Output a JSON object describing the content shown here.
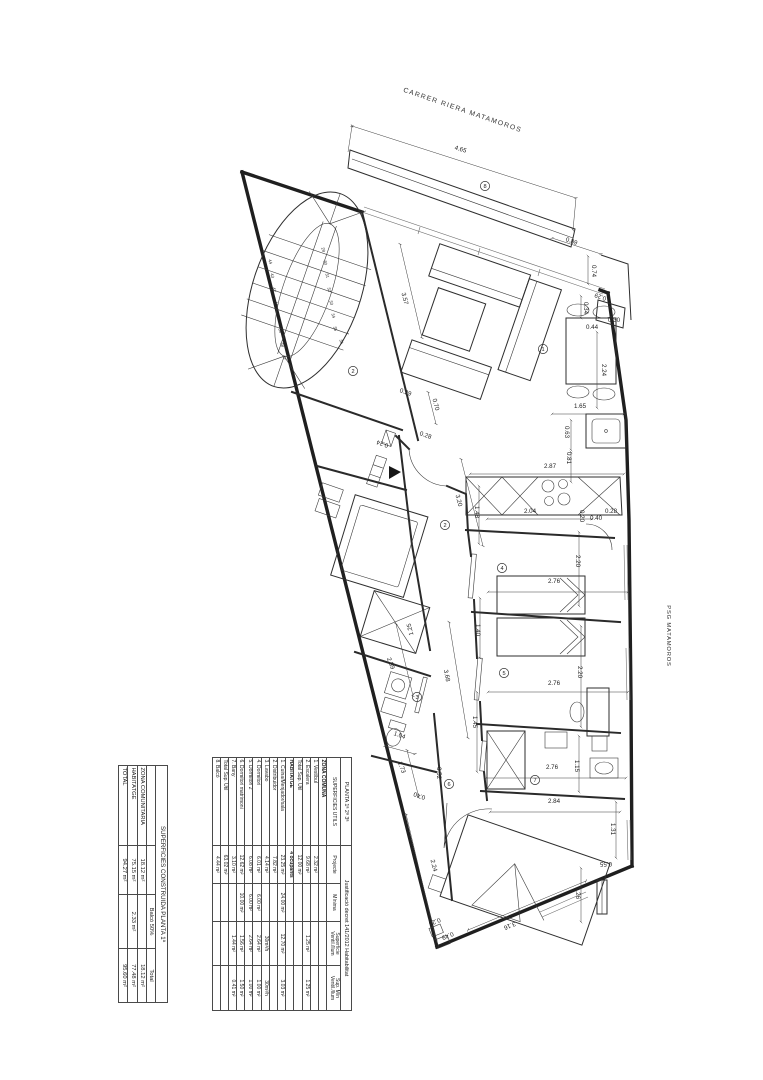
{
  "colors": {
    "ink": "#1f1f1f",
    "paper": "#ffffff"
  },
  "plan": {
    "street_labels": [
      {
        "text": "CARRER RIERA MATAMOROS",
        "x": 462,
        "y": 112,
        "r": 19,
        "s": 6.8,
        "cls": "street"
      },
      {
        "text": "PSG MATAMOROS",
        "x": 667,
        "y": 636,
        "r": 90,
        "s": 5.8,
        "cls": "psg"
      }
    ],
    "dimensions": [
      {
        "t": "4.65",
        "x": 460,
        "y": 151,
        "r": 17
      },
      {
        "t": "0.89",
        "x": 571,
        "y": 243,
        "r": 19
      },
      {
        "t": "0.74",
        "x": 592,
        "y": 271,
        "r": 90
      },
      {
        "t": "0.29",
        "x": 601,
        "y": 295,
        "r": 199
      },
      {
        "t": "0.34",
        "x": 584,
        "y": 308,
        "r": 90
      },
      {
        "t": "0.44",
        "x": 592,
        "y": 329,
        "r": 0
      },
      {
        "t": "0.30",
        "x": 614,
        "y": 322,
        "r": 0
      },
      {
        "t": "2.24",
        "x": 602,
        "y": 370,
        "r": 90
      },
      {
        "t": "1.65",
        "x": 580,
        "y": 408,
        "r": 0
      },
      {
        "t": "0.63",
        "x": 565,
        "y": 432,
        "r": 90
      },
      {
        "t": "0.81",
        "x": 567,
        "y": 458,
        "r": 90
      },
      {
        "t": "2.87",
        "x": 550,
        "y": 468,
        "r": 0
      },
      {
        "t": "1.48",
        "x": 475,
        "y": 512,
        "r": 90
      },
      {
        "t": "2.04",
        "x": 530,
        "y": 513,
        "r": 0
      },
      {
        "t": "0.40",
        "x": 596,
        "y": 520,
        "r": 0
      },
      {
        "t": "0.28",
        "x": 611,
        "y": 513,
        "r": 0
      },
      {
        "t": "0.20",
        "x": 580,
        "y": 516,
        "r": 90
      },
      {
        "t": "2.20",
        "x": 576,
        "y": 561,
        "r": 90
      },
      {
        "t": "2.76",
        "x": 554,
        "y": 583,
        "r": 0
      },
      {
        "t": "1.40",
        "x": 476,
        "y": 630,
        "r": 90
      },
      {
        "t": "2.20",
        "x": 578,
        "y": 672,
        "r": 90
      },
      {
        "t": "2.76",
        "x": 554,
        "y": 685,
        "r": 0
      },
      {
        "t": "1.45",
        "x": 473,
        "y": 722,
        "r": 90
      },
      {
        "t": "1.15",
        "x": 575,
        "y": 766,
        "r": 90
      },
      {
        "t": "2.76",
        "x": 552,
        "y": 769,
        "r": 0
      },
      {
        "t": "2.84",
        "x": 554,
        "y": 803,
        "r": 0
      },
      {
        "t": "1.31",
        "x": 611,
        "y": 829,
        "r": 90
      },
      {
        "t": "0.55",
        "x": 606,
        "y": 862,
        "r": 180
      },
      {
        "t": "1.26",
        "x": 576,
        "y": 893,
        "r": 90
      },
      {
        "t": "3.16",
        "x": 509,
        "y": 924,
        "r": 158
      },
      {
        "t": "0.28",
        "x": 434,
        "y": 920,
        "r": 158
      },
      {
        "t": "0.49",
        "x": 447,
        "y": 934,
        "r": 158
      },
      {
        "t": "2.24",
        "x": 432,
        "y": 866,
        "r": 76
      },
      {
        "t": "0.40",
        "x": 420,
        "y": 794,
        "r": 199
      },
      {
        "t": "0.52",
        "x": 437,
        "y": 773,
        "r": 90
      },
      {
        "t": "1.73",
        "x": 400,
        "y": 768,
        "r": 70
      },
      {
        "t": "1.04",
        "x": 399,
        "y": 737,
        "r": 19
      },
      {
        "t": "3.68",
        "x": 445,
        "y": 676,
        "r": 78
      },
      {
        "t": "2.59",
        "x": 389,
        "y": 664,
        "r": 70
      },
      {
        "t": "1.25",
        "x": 412,
        "y": 629,
        "r": 256
      },
      {
        "t": "3.20",
        "x": 457,
        "y": 501,
        "r": 75
      },
      {
        "t": "3.57",
        "x": 403,
        "y": 299,
        "r": 76
      },
      {
        "t": "0.29",
        "x": 405,
        "y": 394,
        "r": 19
      },
      {
        "t": "0.70",
        "x": 434,
        "y": 405,
        "r": 76
      },
      {
        "t": "0.28",
        "x": 425,
        "y": 437,
        "r": 19
      },
      {
        "t": "0.24",
        "x": 383,
        "y": 442,
        "r": 199
      }
    ],
    "room_numbers": [
      {
        "n": "8",
        "x": 485,
        "y": 186
      },
      {
        "n": "2",
        "x": 353,
        "y": 371
      },
      {
        "n": "1",
        "x": 543,
        "y": 349
      },
      {
        "n": "2",
        "x": 445,
        "y": 525
      },
      {
        "n": "4",
        "x": 502,
        "y": 568
      },
      {
        "n": "5",
        "x": 504,
        "y": 673
      },
      {
        "n": "3",
        "x": 417,
        "y": 697
      },
      {
        "n": "7",
        "x": 535,
        "y": 780
      },
      {
        "n": "6",
        "x": 449,
        "y": 784
      }
    ],
    "stair_step_numbers": [
      {
        "n": "44",
        "x": 269,
        "y": 262
      },
      {
        "n": "43",
        "x": 271,
        "y": 276
      },
      {
        "n": "42",
        "x": 273,
        "y": 290
      },
      {
        "n": "41",
        "x": 275,
        "y": 304
      },
      {
        "n": "40",
        "x": 277,
        "y": 317
      },
      {
        "n": "39",
        "x": 279,
        "y": 331
      },
      {
        "n": "38",
        "x": 281,
        "y": 345
      },
      {
        "n": "37",
        "x": 283,
        "y": 358
      },
      {
        "n": "29",
        "x": 322,
        "y": 250
      },
      {
        "n": "30",
        "x": 324,
        "y": 263
      },
      {
        "n": "31",
        "x": 326,
        "y": 276
      },
      {
        "n": "32",
        "x": 328,
        "y": 290
      },
      {
        "n": "33",
        "x": 330,
        "y": 303
      },
      {
        "n": "34",
        "x": 332,
        "y": 316
      },
      {
        "n": "35",
        "x": 334,
        "y": 329
      },
      {
        "n": "36",
        "x": 340,
        "y": 342
      }
    ]
  },
  "tables": {
    "superficies_utils": {
      "title_left": "PLANTA 1ª 2ª 3ª",
      "title_right": "Justificació decret 141/2012 Habitabilitat",
      "columns": [
        "SUPERFICIES UTILS",
        "Projecte",
        "Mínima",
        "Superficie\nVentil./llum",
        "Sup. Mín\nVentil./llum"
      ],
      "rows": [
        {
          "kind": "section",
          "label": "ZONA COMUNA",
          "c1": "",
          "c2": "",
          "c3": "",
          "c4": ""
        },
        {
          "kind": "row",
          "label": "1. Vestíbul",
          "c1": "2.32 m²",
          "c2": "",
          "c3": "",
          "c4": ""
        },
        {
          "kind": "row",
          "label": "2. Escalera",
          "c1": "9.68 m²",
          "c2": "",
          "c3": "1.25 m²",
          "c4": "1.25 m²"
        },
        {
          "kind": "total",
          "label": "Total Sup. Util",
          "c1": "12.00 m²",
          "c2": "",
          "c3": "",
          "c4": ""
        },
        {
          "kind": "section",
          "label": "HABITATGE",
          "c1": "4 ocupants",
          "c2": "",
          "c3": "",
          "c4": ""
        },
        {
          "kind": "row",
          "label": "1. Cuina/Menjador/sala",
          "c1": "23.25 m²",
          "c2": "24.00 m²",
          "c3": "12.70 m²",
          "c4": "3.03 m²"
        },
        {
          "kind": "row",
          "label": "2. Distribuidor",
          "c1": "7.82 m²",
          "c2": "",
          "c3": "",
          "c4": ""
        },
        {
          "kind": "row",
          "label": "3. Lavabo",
          "c1": "4.14 m²",
          "c2": "",
          "c3": "30m³/h",
          "c4": "30m³/h"
        },
        {
          "kind": "row",
          "label": "4. Dormitori",
          "c1": "6.01 m²",
          "c2": "6.00 m²",
          "c3": "2.64 m²",
          "c4": "1.00 m²"
        },
        {
          "kind": "row",
          "label": "5. Dormitori 2",
          "c1": "6.08 m²",
          "c2": "6.00 m²",
          "c3": "2.64 m²",
          "c4": "1.00 m²"
        },
        {
          "kind": "row",
          "label": "6. Dormitori matrimoni",
          "c1": "12.62 m²",
          "c2": "10.00 m²",
          "c3": "1.56 m²",
          "c4": "1.50 m²"
        },
        {
          "kind": "row",
          "label": "7. Bany",
          "c1": "3.10 m²",
          "c2": "",
          "c3": "1.44 m²",
          "c4": "0.41 m²"
        },
        {
          "kind": "total",
          "label": "Total Sup. Util",
          "c1": "63.02 m²",
          "c2": "",
          "c3": "",
          "c4": ""
        },
        {
          "kind": "row",
          "label": "8. Balcó",
          "c1": "4.44 m²",
          "c2": "",
          "c3": "",
          "c4": ""
        }
      ]
    },
    "superficies_construida": {
      "title": "SUPERFICIES CONSTRUIDA PLANTA 1ª",
      "columns": [
        "",
        "",
        "Balcó 50%",
        "Total"
      ],
      "rows": [
        {
          "label": "ZONA COMUNITARIA",
          "c1": "18.12 m²",
          "c2": "",
          "c3": "18.12 m²"
        },
        {
          "label": "HABITATGE",
          "c1": "75.15 m²",
          "c2": "2.33 m²",
          "c3": "77.48 m²"
        },
        {
          "label": "TOTAL",
          "c1": "94.27 m²",
          "c2": "",
          "c3": "95.60 m²"
        }
      ]
    }
  }
}
